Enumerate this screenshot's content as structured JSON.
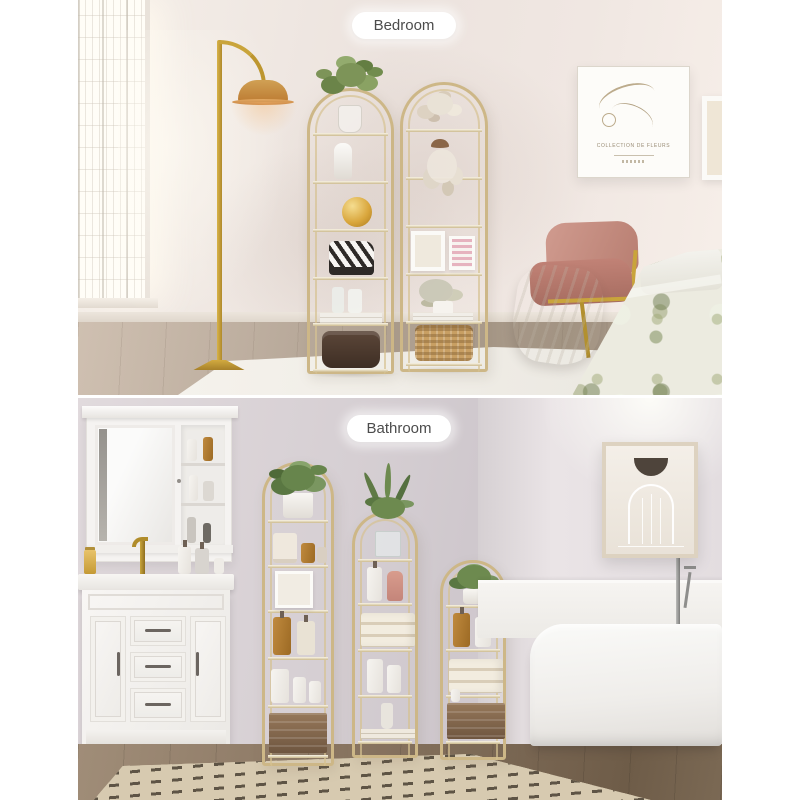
{
  "image_type": "two-panel product lifestyle photo",
  "labels": {
    "bedroom": "Bedroom",
    "bathroom": "Bathroom"
  },
  "bedroom": {
    "poster_title": "COLLECTION DE FLEURS",
    "objects": [
      "sunlit lattice window",
      "gold arc floor lamp with orange shade",
      "two gold arched etagere shelves with decor",
      "botanical line-art wall poster",
      "partial wall frame",
      "dusty-pink accent chair with gold legs",
      "white throw blanket",
      "bed with sage floral comforter",
      "white area rug on wood floor"
    ]
  },
  "bathroom": {
    "objects": [
      "white medicine cabinet with mirror and open shelves",
      "white vanity with brass faucet and toiletries",
      "gold arched etagere shelves in three heights with plants, bottles, towels and crates",
      "framed arch line-art print",
      "white freestanding bathtub with chrome floor faucet",
      "white wainscoting",
      "beige dash-pattern rug on dark wood floor"
    ]
  },
  "palette": {
    "canvas": "#ffffff",
    "shelf_gold": "#cdb787",
    "lamp_gold": "#c9a43b",
    "chair_pink": "#c08175",
    "bedroom_wall": "#efe6e1",
    "bathroom_wall": "#d7d0d4",
    "bedroom_floor": "#b3a495",
    "bathroom_floor": "#83705c",
    "rug_beige": "#d6c9ad",
    "amber_bottle": "#b5812f",
    "plant_green": "#6d8a4f"
  }
}
